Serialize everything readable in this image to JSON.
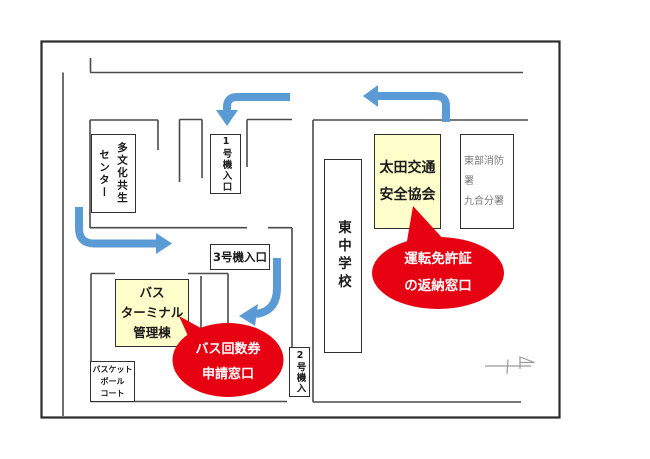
{
  "map": {
    "labels": {
      "multicultural_center": {
        "lines": [
          "多文化共生",
          "センター"
        ]
      },
      "gate1": {
        "text": "1号機入口"
      },
      "gate3": {
        "text": "3号機入口"
      },
      "gate2": {
        "text": "2号機入"
      },
      "bus_terminal": {
        "lines": [
          "バス",
          "ターミナル",
          "管理棟"
        ]
      },
      "basketball_court": {
        "lines": [
          "バスケット",
          "ボール",
          "コート"
        ]
      },
      "junior_high_school": {
        "text": "東中学校"
      },
      "traffic_safety_assoc": {
        "lines": [
          "太田交通",
          "安全協会"
        ]
      },
      "fire_station": {
        "lines": [
          "東部消防署",
          "九合分署"
        ]
      }
    },
    "callouts": {
      "license_return": {
        "lines": [
          "運転免許証",
          "の返納窓口"
        ]
      },
      "bus_ticket": {
        "lines": [
          "バス回数券",
          "申請窓口"
        ]
      }
    },
    "colors": {
      "arrow": "#5b9bd5",
      "highlight_fill": "#ffffcc",
      "callout_fill": "#e60012",
      "road_line": "#4a4a4a",
      "muted_text": "#7a7a7a"
    }
  }
}
